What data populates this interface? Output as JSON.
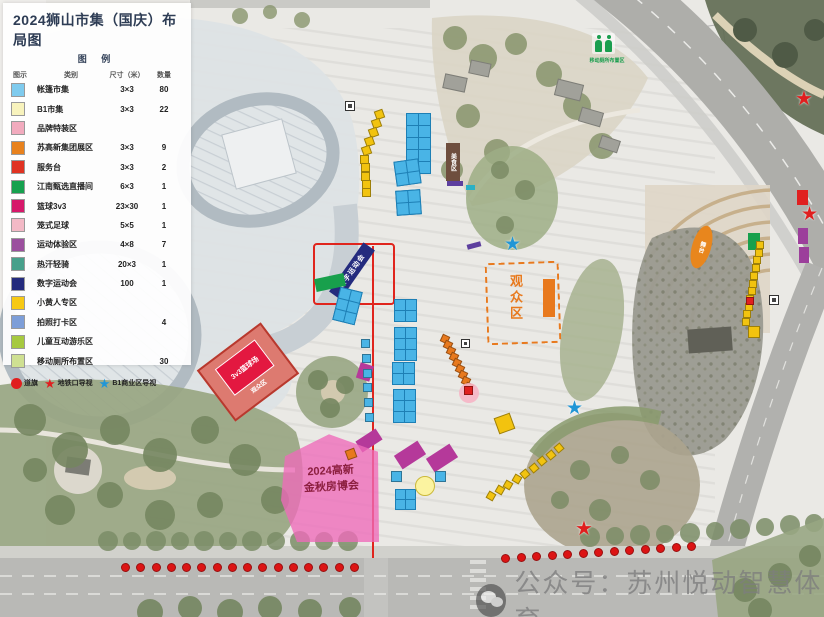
{
  "title": "2024狮山市集（国庆）布局图",
  "subtitle": "图 例",
  "legend": {
    "headers": [
      "图示",
      "类别",
      "尺寸（米）",
      "数量"
    ],
    "rows": [
      {
        "color": "#7fcbee",
        "name": "帐篷市集",
        "size": "3×3",
        "qty": "80"
      },
      {
        "color": "#f8f3bd",
        "name": "B1市集",
        "size": "3×3",
        "qty": "22"
      },
      {
        "color": "#f2abbe",
        "name": "品牌特装区",
        "size": "",
        "qty": ""
      },
      {
        "color": "#e8821e",
        "name": "苏高新集团展区",
        "size": "3×3",
        "qty": "9"
      },
      {
        "color": "#e03323",
        "name": "服务台",
        "size": "3×3",
        "qty": "2"
      },
      {
        "color": "#16a14f",
        "name": "江南甄选直播间",
        "size": "6×3",
        "qty": "1"
      },
      {
        "color": "#d6186a",
        "name": "篮球3v3",
        "size": "23×30",
        "qty": "1"
      },
      {
        "color": "#f3b9c6",
        "name": "笼式足球",
        "size": "5×5",
        "qty": "1"
      },
      {
        "color": "#9b4f9e",
        "name": "运动体验区",
        "size": "4×8",
        "qty": "7"
      },
      {
        "color": "#47a08b",
        "name": "热汗轻骑",
        "size": "20×3",
        "qty": "1"
      },
      {
        "color": "#232a7d",
        "name": "数字运动会",
        "size": "100",
        "qty": "1"
      },
      {
        "color": "#f7c914",
        "name": "小黄人专区",
        "size": "",
        "qty": ""
      },
      {
        "color": "#7d9ed8",
        "name": "拍照打卡区",
        "size": "",
        "qty": "4"
      },
      {
        "color": "#a6c940",
        "name": "儿童互动游乐区",
        "size": "",
        "qty": ""
      },
      {
        "color": "#cfe092",
        "name": "移动厕所布置区",
        "size": "",
        "qty": "30"
      }
    ],
    "symbols": [
      {
        "shape": "circle",
        "color": "#e01f1f",
        "label": "道旗"
      },
      {
        "shape": "star",
        "color": "#e01f1f",
        "label": "地铁口导视"
      },
      {
        "shape": "star",
        "color": "#2196d6",
        "label": "B1商业区导视"
      }
    ]
  },
  "map": {
    "watermark": "公众号：苏州悦动智慧体育",
    "markers": [
      {
        "t": "outline",
        "name": "route-box",
        "x": 313,
        "y": 243,
        "w": 82,
        "h": 62,
        "bc": "#e0251d"
      },
      {
        "t": "line",
        "name": "route-line",
        "x": 372,
        "y": 246,
        "w": 2,
        "h": 312,
        "c": "#e0251d"
      },
      {
        "t": "rect",
        "name": "digital-games-banner",
        "x": 322,
        "y": 264,
        "w": 60,
        "h": 14,
        "r": -55,
        "c": "#242b7e",
        "tx": "数字运动会",
        "tc": "#ffffff",
        "fs": 7,
        "ls": 1
      },
      {
        "t": "rect",
        "name": "food-zone-sign",
        "x": 446,
        "y": 143,
        "w": 14,
        "h": 38,
        "c": "#6e4e3e",
        "tx": "美食区",
        "tc": "#ffffff",
        "fs": 6,
        "vert": true
      },
      {
        "t": "rect",
        "name": "livestream-booth",
        "x": 315,
        "y": 276,
        "w": 30,
        "h": 13,
        "r": -12,
        "c": "#18a04c"
      },
      {
        "t": "rect",
        "name": "green-booth",
        "x": 748,
        "y": 233,
        "w": 12,
        "h": 17,
        "c": "#18a04c"
      },
      {
        "t": "rect",
        "x": 447,
        "y": 181,
        "w": 16,
        "h": 5,
        "c": "#5d3f9e"
      },
      {
        "t": "rect",
        "x": 467,
        "y": 243,
        "w": 14,
        "h": 5,
        "r": -15,
        "c": "#5d3f9e"
      },
      {
        "t": "rect",
        "x": 798,
        "y": 228,
        "w": 10,
        "h": 16,
        "c": "#9c3f9b"
      },
      {
        "t": "rect",
        "x": 799,
        "y": 247,
        "w": 10,
        "h": 16,
        "c": "#9c3f9b"
      },
      {
        "t": "rect",
        "x": 357,
        "y": 434,
        "w": 24,
        "h": 13,
        "r": -33,
        "c": "#b5399a"
      },
      {
        "t": "rect",
        "x": 396,
        "y": 447,
        "w": 28,
        "h": 16,
        "r": -33,
        "c": "#b5399a"
      },
      {
        "t": "rect",
        "x": 428,
        "y": 450,
        "w": 28,
        "h": 16,
        "r": -33,
        "c": "#b5399a"
      },
      {
        "t": "rect",
        "x": 358,
        "y": 364,
        "w": 14,
        "h": 16,
        "r": 18,
        "c": "#b5399a"
      },
      {
        "t": "rect",
        "x": 466,
        "y": 185,
        "w": 9,
        "h": 5,
        "c": "#2ab0c5"
      },
      {
        "t": "court",
        "name": "court-3v3",
        "x": 208,
        "y": 340,
        "w": 80,
        "h": 64,
        "r": -37,
        "oc": "#dd7a70",
        "ic": "#e31840",
        "tx": "3v3篮球场",
        "tx2": "观众区"
      },
      {
        "t": "outline",
        "name": "audience-area",
        "x": 486,
        "y": 262,
        "w": 74,
        "h": 82,
        "bc": "#e8791d",
        "dash": true,
        "r": -2
      },
      {
        "t": "label",
        "name": "audience-area-label",
        "x": 506,
        "y": 274,
        "tx": "观众区",
        "tc": "#e8791d",
        "fs": 13,
        "vert": true,
        "ls": 3
      },
      {
        "t": "rect",
        "name": "stage-strip",
        "x": 543,
        "y": 279,
        "w": 12,
        "h": 38,
        "c": "#e8791d"
      },
      {
        "t": "rect",
        "name": "stage-right",
        "x": 692,
        "y": 225,
        "w": 19,
        "h": 44,
        "r": 16,
        "c": "#e8861d",
        "tx": "舞台",
        "tc": "#ffffff",
        "fs": 6,
        "vert": true,
        "round": true
      },
      {
        "t": "clip",
        "name": "expo-area",
        "x": 281,
        "y": 432,
        "w": 100,
        "h": 110,
        "c": "rgba(238,106,186,.78)",
        "poly": "4% 22%,48% 2%,97% 18%,98% 100%,16% 100%,0% 62%"
      },
      {
        "t": "label",
        "name": "expo-label",
        "x": 283,
        "y": 462,
        "w": 96,
        "tx": "2024高新\n金秋房博会",
        "tc": "#8c1f3f",
        "fs": 11,
        "r": -3
      },
      {
        "t": "grid",
        "x": 406,
        "y": 113,
        "cols": 2,
        "rows": 5,
        "cell": 11
      },
      {
        "t": "grid",
        "x": 395,
        "y": 160,
        "cols": 2,
        "rows": 2,
        "cell": 11,
        "r": -8
      },
      {
        "t": "grid",
        "x": 396,
        "y": 190,
        "cols": 2,
        "rows": 2,
        "cell": 11,
        "r": -4
      },
      {
        "t": "grid",
        "x": 336,
        "y": 289,
        "cols": 2,
        "rows": 3,
        "cell": 10,
        "r": 14
      },
      {
        "t": "grid",
        "x": 394,
        "y": 299,
        "cols": 2,
        "rows": 2,
        "cell": 10
      },
      {
        "t": "grid",
        "x": 394,
        "y": 327,
        "cols": 2,
        "rows": 3,
        "cell": 10
      },
      {
        "t": "grid",
        "x": 392,
        "y": 362,
        "cols": 2,
        "rows": 2,
        "cell": 10
      },
      {
        "t": "grid",
        "x": 393,
        "y": 389,
        "cols": 2,
        "rows": 3,
        "cell": 10
      },
      {
        "t": "grid",
        "x": 395,
        "y": 489,
        "cols": 2,
        "rows": 2,
        "cell": 9
      },
      {
        "t": "sqrow",
        "x1": 361,
        "y1": 339,
        "x2": 365,
        "y2": 413,
        "n": 6,
        "s": 9,
        "c": "#49b4e6"
      },
      {
        "t": "sq",
        "x": 391,
        "y": 471,
        "s": 11,
        "c": "#49b4e6"
      },
      {
        "t": "sq",
        "x": 435,
        "y": 471,
        "s": 11,
        "c": "#49b4e6"
      },
      {
        "t": "sqrow",
        "x1": 375,
        "y1": 110,
        "x2": 362,
        "y2": 146,
        "n": 5,
        "s": 9,
        "c": "#f2c30f",
        "r": -20
      },
      {
        "t": "sqrow",
        "x1": 360,
        "y1": 155,
        "x2": 362,
        "y2": 188,
        "n": 5,
        "s": 9,
        "c": "#f2c30f"
      },
      {
        "t": "sqrow",
        "x1": 756,
        "y1": 241,
        "x2": 742,
        "y2": 318,
        "n": 11,
        "s": 8,
        "c": "#f2c30f"
      },
      {
        "t": "sq",
        "x": 746,
        "y": 297,
        "s": 8,
        "c": "#e02020"
      },
      {
        "t": "sqrow",
        "x1": 555,
        "y1": 444,
        "x2": 521,
        "y2": 470,
        "n": 5,
        "s": 8,
        "c": "#f2c30f",
        "r": -40
      },
      {
        "t": "sqrow",
        "x1": 513,
        "y1": 475,
        "x2": 487,
        "y2": 492,
        "n": 4,
        "s": 8,
        "c": "#f2c30f",
        "r": -60
      },
      {
        "t": "sq",
        "x": 496,
        "y": 415,
        "s": 17,
        "c": "#f2c30f",
        "r": -20
      },
      {
        "t": "sq",
        "x": 748,
        "y": 326,
        "s": 12,
        "c": "#f2c30f"
      },
      {
        "t": "circle",
        "x": 415,
        "y": 476,
        "d": 20,
        "c": "#fbf3a0",
        "bc": "#cbb93a"
      },
      {
        "t": "sqrow",
        "x1": 441,
        "y1": 335,
        "x2": 465,
        "y2": 383,
        "n": 9,
        "s": 8,
        "c": "#e8791d",
        "r": 25
      },
      {
        "t": "sq",
        "x": 346,
        "y": 449,
        "s": 10,
        "c": "#e8791d",
        "r": -20
      },
      {
        "t": "circle",
        "x": 459,
        "y": 383,
        "d": 20,
        "c": "rgba(246,181,197,.9)",
        "bc": "rgba(0,0,0,0)"
      },
      {
        "t": "sq",
        "x": 464,
        "y": 386,
        "s": 9,
        "c": "#e02020"
      },
      {
        "t": "rect",
        "x": 797,
        "y": 190,
        "w": 11,
        "h": 15,
        "c": "#e02020"
      },
      {
        "t": "star",
        "name": "metro-sign-star",
        "x": 795,
        "y": 88,
        "c": "#e01f1f",
        "s": 20
      },
      {
        "t": "star",
        "name": "metro-sign-star",
        "x": 801,
        "y": 205,
        "c": "#e01f1f",
        "s": 19
      },
      {
        "t": "star",
        "name": "metro-sign-star",
        "x": 575,
        "y": 518,
        "c": "#e01f1f",
        "s": 20
      },
      {
        "t": "star",
        "name": "b1-sign-star",
        "x": 504,
        "y": 235,
        "c": "#2196d6",
        "s": 19
      },
      {
        "t": "star",
        "name": "b1-sign-star",
        "x": 566,
        "y": 399,
        "c": "#2196d6",
        "s": 19
      },
      {
        "t": "icon",
        "x": 345,
        "y": 101,
        "s": 10
      },
      {
        "t": "icon",
        "x": 769,
        "y": 295,
        "s": 10
      },
      {
        "t": "icon",
        "x": 461,
        "y": 339,
        "s": 9
      },
      {
        "t": "toilet",
        "name": "toilet-icon",
        "x": 592,
        "y": 33
      },
      {
        "t": "label",
        "name": "toilet-label",
        "x": 576,
        "y": 57,
        "w": 62,
        "tx": "移动厕所布置区",
        "tc": "#1a9e4e",
        "fs": 5
      },
      {
        "t": "dotrow",
        "name": "road-flag-dots",
        "x1": 121,
        "y1": 563,
        "x2": 350,
        "y2": 563,
        "n": 16,
        "s": 9,
        "c": "#dc1414"
      },
      {
        "t": "dotrow",
        "name": "road-flag-dots",
        "x1": 501,
        "y1": 554,
        "x2": 687,
        "y2": 542,
        "n": 13,
        "s": 9,
        "c": "#dc1414"
      }
    ]
  }
}
